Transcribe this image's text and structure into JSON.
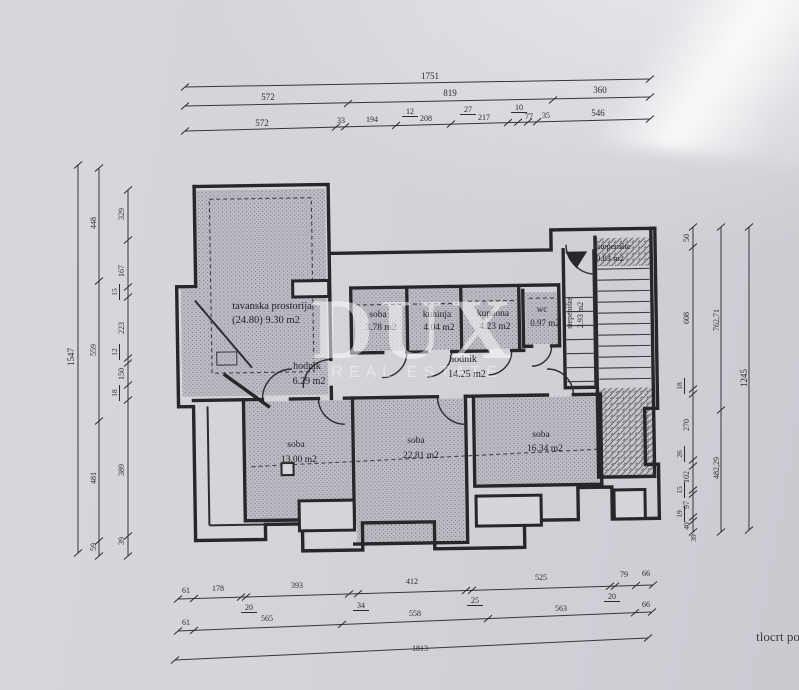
{
  "document": {
    "caption": "tlocrt po",
    "watermark": {
      "line1": "DUX",
      "line2": "REAL ESTATE"
    }
  },
  "rooms": [
    {
      "name": "tavanska prostorija",
      "area": "(24.80) 9.30 m2"
    },
    {
      "name": "soba",
      "area": "3.78 m2"
    },
    {
      "name": "kuhinja",
      "area": "4.04 m2"
    },
    {
      "name": "kupaona",
      "area": "4.23 m2"
    },
    {
      "name": "wc",
      "area": "0.97 m2"
    },
    {
      "name": "hodnik",
      "area": "6.29 m2"
    },
    {
      "name": "hodnik",
      "area": "14.25 m2"
    },
    {
      "name": "stepenište",
      "area": "9.83 m2"
    },
    {
      "name": "stepenište",
      "area": "2.93 m2"
    },
    {
      "name": "soba",
      "area": "13.00 m2"
    },
    {
      "name": "soba",
      "area": "22.81 m2"
    },
    {
      "name": "soba",
      "area": "16.34 m2"
    }
  ],
  "dimensions": {
    "top": [
      [
        "1751"
      ],
      [
        "572",
        "819",
        "360"
      ],
      [
        "572",
        "33",
        "194",
        "12",
        "208",
        "27",
        "217",
        "10",
        "77",
        "35",
        "546"
      ]
    ],
    "bottom": [
      [
        "61",
        "178",
        "20",
        "393",
        "34",
        "412",
        "25",
        "525",
        "20",
        "79",
        "66"
      ],
      [
        "61",
        "565",
        "558",
        "563",
        "66"
      ],
      [
        "1813"
      ]
    ],
    "left": [
      [
        "1547"
      ],
      [
        "448",
        "559",
        "481",
        "59"
      ],
      [
        "329",
        "167",
        "15",
        "223",
        "12",
        "150",
        "18",
        "389",
        "39"
      ]
    ],
    "right": [
      [
        "50",
        "608",
        "18",
        "270",
        "26",
        "102",
        "15",
        "97",
        "19",
        "40",
        "39"
      ],
      [
        "762,71",
        "482,29"
      ],
      [
        "1245"
      ]
    ]
  },
  "labels": {
    "dims_top": [
      {
        "t": "1751",
        "x": 430,
        "y": 79,
        "s": 9
      },
      {
        "t": "572",
        "x": 268,
        "y": 100,
        "s": 9
      },
      {
        "t": "819",
        "x": 450,
        "y": 96,
        "s": 9
      },
      {
        "t": "360",
        "x": 600,
        "y": 93,
        "s": 9
      },
      {
        "t": "572",
        "x": 262,
        "y": 126,
        "s": 9
      },
      {
        "t": "33",
        "x": 341,
        "y": 123,
        "s": 8
      },
      {
        "t": "194",
        "x": 372,
        "y": 122,
        "s": 8
      },
      {
        "t": "12",
        "x": 410,
        "y": 114,
        "s": 8,
        "u": 1
      },
      {
        "t": "208",
        "x": 426,
        "y": 121,
        "s": 8
      },
      {
        "t": "27",
        "x": 468,
        "y": 112,
        "s": 8,
        "u": 1
      },
      {
        "t": "217",
        "x": 484,
        "y": 120,
        "s": 8
      },
      {
        "t": "10",
        "x": 519,
        "y": 110,
        "s": 8,
        "u": 1
      },
      {
        "t": "77",
        "x": 529,
        "y": 119,
        "s": 8
      },
      {
        "t": "35",
        "x": 546,
        "y": 118,
        "s": 8
      },
      {
        "t": "546",
        "x": 598,
        "y": 116,
        "s": 9
      }
    ],
    "dims_bottom": [
      {
        "t": "61",
        "x": 186,
        "y": 593,
        "s": 8
      },
      {
        "t": "178",
        "x": 218,
        "y": 591,
        "s": 8
      },
      {
        "t": "20",
        "x": 249,
        "y": 610,
        "s": 8,
        "u": 1
      },
      {
        "t": "393",
        "x": 297,
        "y": 588,
        "s": 8
      },
      {
        "t": "34",
        "x": 361,
        "y": 608,
        "s": 8,
        "u": 1
      },
      {
        "t": "412",
        "x": 412,
        "y": 584,
        "s": 8
      },
      {
        "t": "25",
        "x": 475,
        "y": 603,
        "s": 8,
        "u": 1
      },
      {
        "t": "525",
        "x": 541,
        "y": 580,
        "s": 8
      },
      {
        "t": "20",
        "x": 612,
        "y": 599,
        "s": 8,
        "u": 1
      },
      {
        "t": "79",
        "x": 624,
        "y": 577,
        "s": 8
      },
      {
        "t": "66",
        "x": 646,
        "y": 576,
        "s": 8
      },
      {
        "t": "61",
        "x": 186,
        "y": 625,
        "s": 8
      },
      {
        "t": "565",
        "x": 267,
        "y": 621,
        "s": 8
      },
      {
        "t": "558",
        "x": 415,
        "y": 616,
        "s": 8
      },
      {
        "t": "563",
        "x": 561,
        "y": 611,
        "s": 8
      },
      {
        "t": "66",
        "x": 646,
        "y": 607,
        "s": 8
      },
      {
        "t": "1813",
        "x": 420,
        "y": 651,
        "s": 8
      }
    ],
    "dims_left": [
      {
        "t": "1547",
        "x": 74,
        "y": 357,
        "s": 9,
        "r": -90
      },
      {
        "t": "448",
        "x": 96,
        "y": 223,
        "s": 8,
        "r": -90
      },
      {
        "t": "559",
        "x": 96,
        "y": 350,
        "s": 8,
        "r": -90
      },
      {
        "t": "481",
        "x": 96,
        "y": 478,
        "s": 8,
        "r": -90
      },
      {
        "t": "59",
        "x": 96,
        "y": 547,
        "s": 8,
        "r": -90
      },
      {
        "t": "329",
        "x": 124,
        "y": 214,
        "s": 8,
        "r": -90
      },
      {
        "t": "167",
        "x": 124,
        "y": 271,
        "s": 8,
        "r": -90
      },
      {
        "t": "15",
        "x": 117,
        "y": 292,
        "s": 7.5,
        "r": -90,
        "u": 1
      },
      {
        "t": "223",
        "x": 124,
        "y": 328,
        "s": 8,
        "r": -90
      },
      {
        "t": "12",
        "x": 117,
        "y": 352,
        "s": 7.5,
        "r": -90,
        "u": 1
      },
      {
        "t": "150",
        "x": 124,
        "y": 374,
        "s": 8,
        "r": -90
      },
      {
        "t": "18",
        "x": 117,
        "y": 393,
        "s": 7.5,
        "r": -90,
        "u": 1
      },
      {
        "t": "389",
        "x": 124,
        "y": 470,
        "s": 8,
        "r": -90
      },
      {
        "t": "39",
        "x": 124,
        "y": 541,
        "s": 8,
        "r": -90
      }
    ],
    "dims_right": [
      {
        "t": "50",
        "x": 689,
        "y": 238,
        "s": 8,
        "r": -90
      },
      {
        "t": "608",
        "x": 689,
        "y": 318,
        "s": 8,
        "r": -90
      },
      {
        "t": "18",
        "x": 682,
        "y": 386,
        "s": 7.5,
        "r": -90,
        "u": 1
      },
      {
        "t": "270",
        "x": 689,
        "y": 425,
        "s": 8,
        "r": -90
      },
      {
        "t": "26",
        "x": 682,
        "y": 454,
        "s": 7.5,
        "r": -90,
        "u": 1
      },
      {
        "t": "102",
        "x": 689,
        "y": 477,
        "s": 8,
        "r": -90
      },
      {
        "t": "15",
        "x": 682,
        "y": 490,
        "s": 7.5,
        "r": -90,
        "u": 1
      },
      {
        "t": "97",
        "x": 689,
        "y": 505,
        "s": 8,
        "r": -90
      },
      {
        "t": "19",
        "x": 682,
        "y": 514,
        "s": 7.5,
        "r": -90,
        "u": 1
      },
      {
        "t": "40",
        "x": 689,
        "y": 526,
        "s": 7.5,
        "r": -90
      },
      {
        "t": "39",
        "x": 696,
        "y": 538,
        "s": 7.5,
        "r": -90
      },
      {
        "t": "762,71",
        "x": 719,
        "y": 320,
        "s": 8,
        "r": -90
      },
      {
        "t": "482,29",
        "x": 719,
        "y": 468,
        "s": 8,
        "r": -90
      },
      {
        "t": "1245",
        "x": 747,
        "y": 378,
        "s": 9,
        "r": -90
      }
    ],
    "rooms": [
      {
        "t": "tavanska prostorija",
        "x": 272,
        "y": 309,
        "s": 10.5,
        "c": "room"
      },
      {
        "t": "(24.80) 9.30 m2",
        "x": 266,
        "y": 323,
        "s": 10.5,
        "c": "room"
      },
      {
        "t": "soba",
        "x": 378,
        "y": 317,
        "s": 9.5,
        "c": "room"
      },
      {
        "t": "3.78 m2",
        "x": 381,
        "y": 330,
        "s": 9.5,
        "c": "room"
      },
      {
        "t": "kuhinja",
        "x": 437,
        "y": 317,
        "s": 9.5,
        "c": "room"
      },
      {
        "t": "4.04 m2",
        "x": 439,
        "y": 330,
        "s": 9.5,
        "c": "room"
      },
      {
        "t": "kupaona",
        "x": 493,
        "y": 316,
        "s": 9.5,
        "c": "room"
      },
      {
        "t": "4.23 m2",
        "x": 495,
        "y": 329,
        "s": 9.5,
        "c": "room"
      },
      {
        "t": "wc",
        "x": 542,
        "y": 312,
        "s": 9,
        "c": "room"
      },
      {
        "t": "0.97 m2",
        "x": 545,
        "y": 326,
        "s": 9,
        "c": "room"
      },
      {
        "t": "hodnik",
        "x": 307,
        "y": 369,
        "s": 10,
        "c": "room"
      },
      {
        "t": "6.29 m2",
        "x": 309,
        "y": 384,
        "s": 10,
        "c": "room"
      },
      {
        "t": "hodnik",
        "x": 463,
        "y": 362,
        "s": 10,
        "c": "room"
      },
      {
        "t": "14.25 m2",
        "x": 467,
        "y": 377,
        "s": 10,
        "c": "room"
      },
      {
        "t": "stepenište",
        "x": 614,
        "y": 249,
        "s": 8.5,
        "c": "room"
      },
      {
        "t": "9.83 m2",
        "x": 610,
        "y": 261,
        "s": 8.5,
        "c": "room"
      },
      {
        "t": "stepenište",
        "x": 572,
        "y": 313,
        "s": 8,
        "r": -90,
        "c": "room"
      },
      {
        "t": "2.93 m2",
        "x": 583,
        "y": 315,
        "s": 8,
        "r": -90,
        "c": "room"
      },
      {
        "t": "soba",
        "x": 296,
        "y": 447,
        "s": 9.5,
        "c": "room"
      },
      {
        "t": "13.00 m2",
        "x": 299,
        "y": 462,
        "s": 9.5,
        "c": "room"
      },
      {
        "t": "soba",
        "x": 416,
        "y": 443,
        "s": 9.5,
        "c": "room"
      },
      {
        "t": "22.81 m2",
        "x": 421,
        "y": 458,
        "s": 9.5,
        "c": "room"
      },
      {
        "t": "soba",
        "x": 541,
        "y": 437,
        "s": 9.5,
        "c": "room"
      },
      {
        "t": "16.34 m2",
        "x": 545,
        "y": 451,
        "s": 9.5,
        "c": "room"
      }
    ],
    "caption": [
      {
        "t": "tlocrt po",
        "x": 778,
        "y": 641,
        "s": 13,
        "c": "caption"
      }
    ]
  }
}
